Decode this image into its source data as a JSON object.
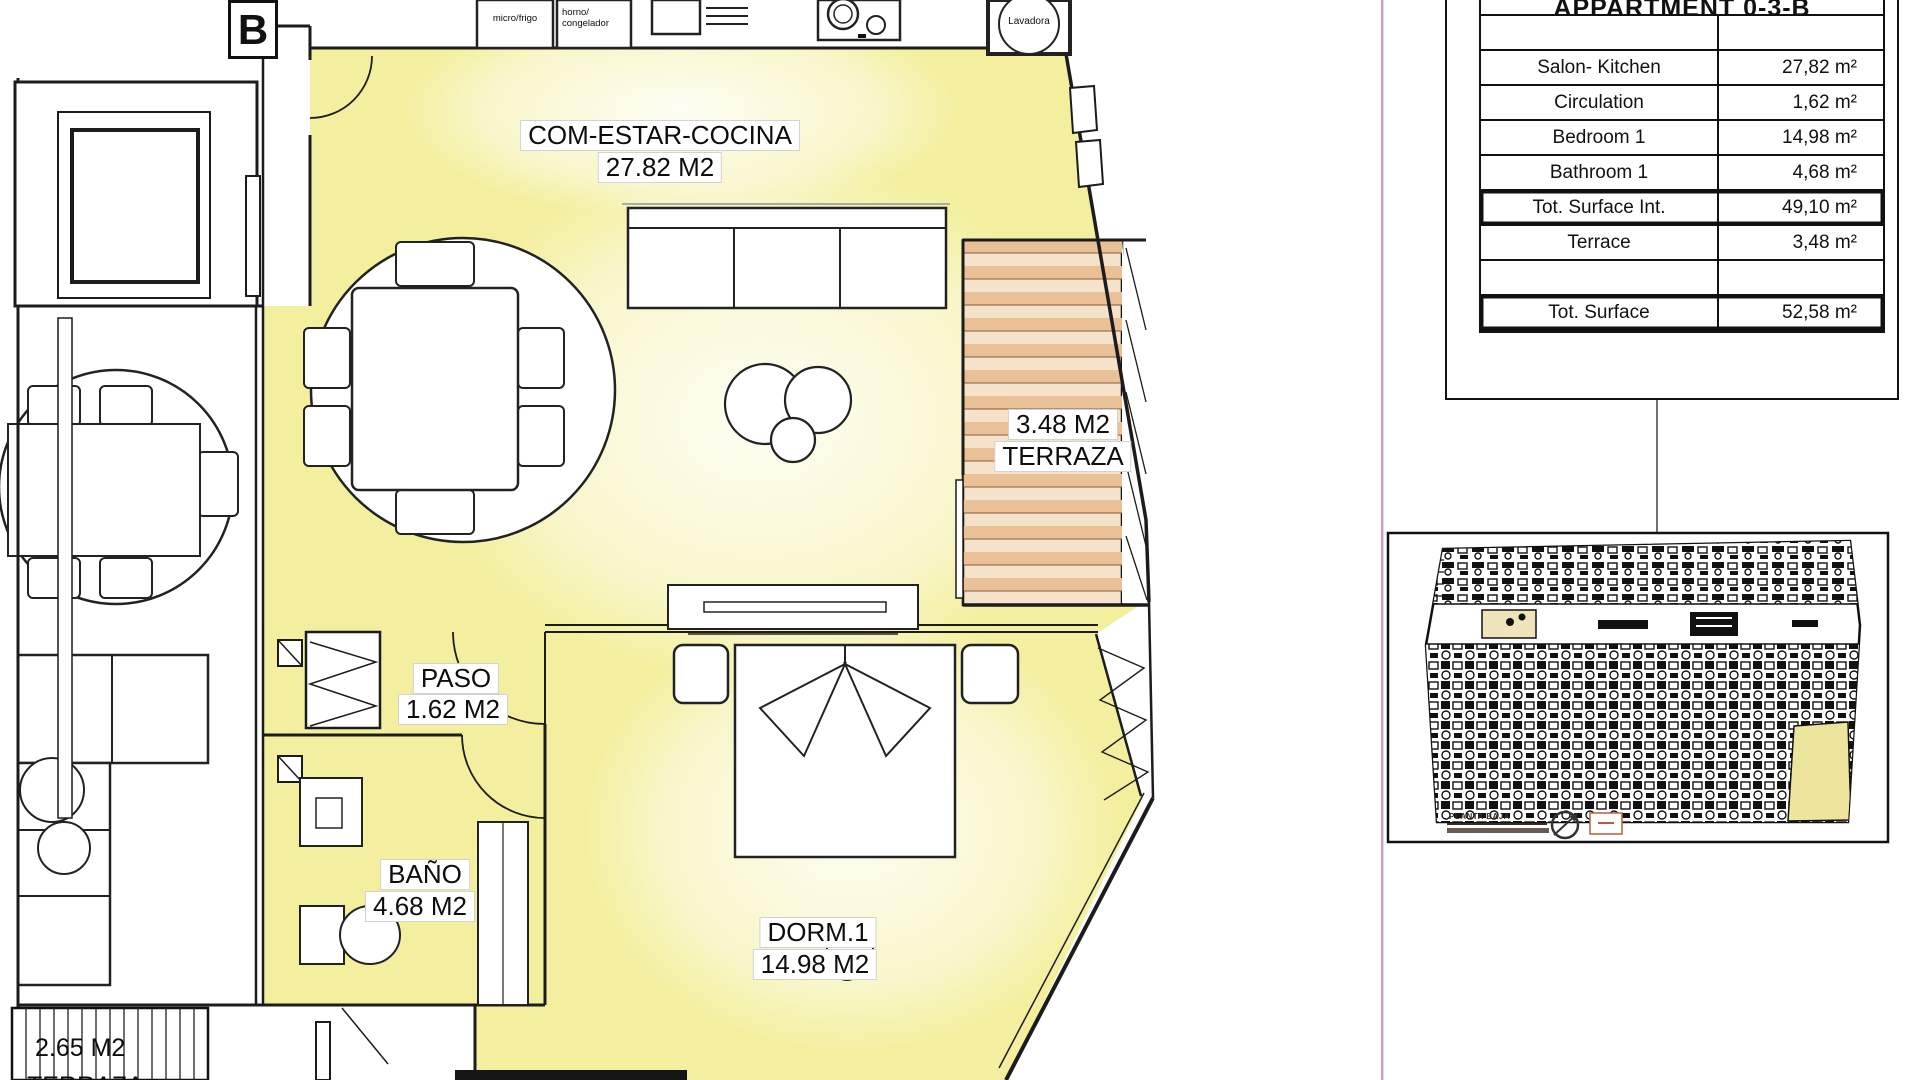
{
  "plan": {
    "unit_label": "B",
    "rooms": {
      "living": {
        "name": "COM-ESTAR-COCINA",
        "area": "27.82 M2"
      },
      "paso": {
        "name": "PASO",
        "area": "1.62 M2"
      },
      "bano": {
        "name": "BAÑO",
        "area": "4.68 M2"
      },
      "dorm": {
        "name": "DORM.1",
        "area": "14.98 M2"
      },
      "terrace": {
        "name": "TERRAZA",
        "area": "3.48 M2"
      },
      "neighbor_terrace": {
        "name": "TERRAZA",
        "area": "2.65 M2"
      }
    },
    "appliances": {
      "micro": "micro/frigo",
      "oven_line1": "horno/",
      "oven_line2": "congelador",
      "washer": "Lavadora"
    }
  },
  "surface_table": {
    "title": "APPARTMENT 0-3-B",
    "rows": [
      {
        "label": "Salon- Kitchen",
        "value": "27,82 m²"
      },
      {
        "label": "Circulation",
        "value": "1,62 m²"
      },
      {
        "label": "Bedroom 1",
        "value": "14,98 m²"
      },
      {
        "label": "Bathroom 1",
        "value": "4,68 m²"
      },
      {
        "label": "Tot. Surface Int.",
        "value": "49,10 m²"
      },
      {
        "label": "Terrace",
        "value": "3,48 m²"
      },
      {
        "label": "",
        "value": ""
      },
      {
        "label": "Tot. Surface",
        "value": "52,58 m²"
      }
    ]
  },
  "key_plan": {
    "caption": "PLANTA BAJA"
  },
  "colors": {
    "plan_yellow": "#F3EF9E",
    "terrace_orange": "#EAC096",
    "guide_pink": "#C9A2C2",
    "highlight_yellow": "#EDE59C"
  }
}
